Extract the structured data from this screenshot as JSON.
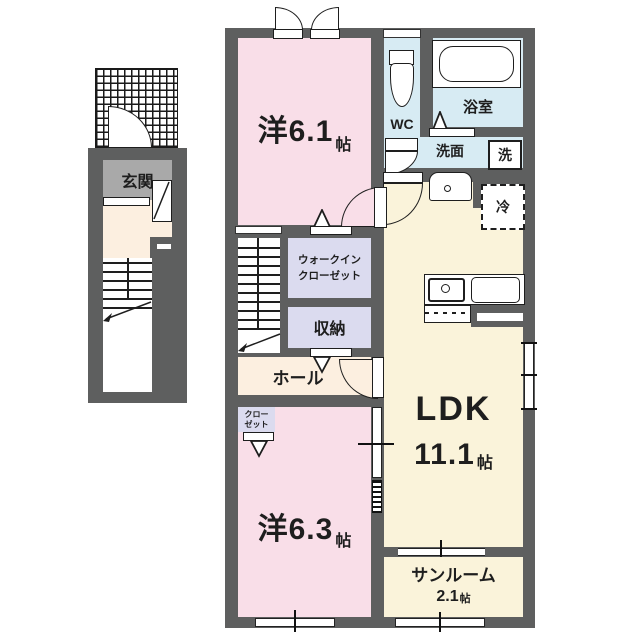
{
  "colors": {
    "wall": "#5e5f5f",
    "room_pink": "#f9dee8",
    "room_cream": "#faf3da",
    "water_blue": "#d7ebf3",
    "closet_purple": "#dbdbef",
    "hall_beige": "#fcefe0",
    "genkan_gray": "#a9a9a9",
    "line": "#1e1e1e"
  },
  "entrance_wing": {
    "genkan_label": "玄関"
  },
  "rooms": {
    "western1": {
      "name": "洋6.1",
      "unit": "帖"
    },
    "western2": {
      "name": "洋6.3",
      "unit": "帖"
    },
    "ldk": {
      "name": "LDK",
      "size": "11.1",
      "unit": "帖"
    },
    "sunroom": {
      "name": "サンルーム",
      "size": "2.1",
      "unit": "帖"
    },
    "wic": {
      "line1": "ウォークイン",
      "line2": "クローゼット"
    },
    "storage": {
      "label": "収納"
    },
    "hall": {
      "label": "ホール"
    },
    "closet": {
      "line1": "クロー",
      "line2": "ゼット"
    },
    "wc": {
      "label": "WC"
    },
    "bath": {
      "label": "浴室"
    },
    "washroom": {
      "label": "洗面"
    },
    "washer": {
      "label": "洗"
    },
    "fridge": {
      "label": "冷"
    }
  }
}
